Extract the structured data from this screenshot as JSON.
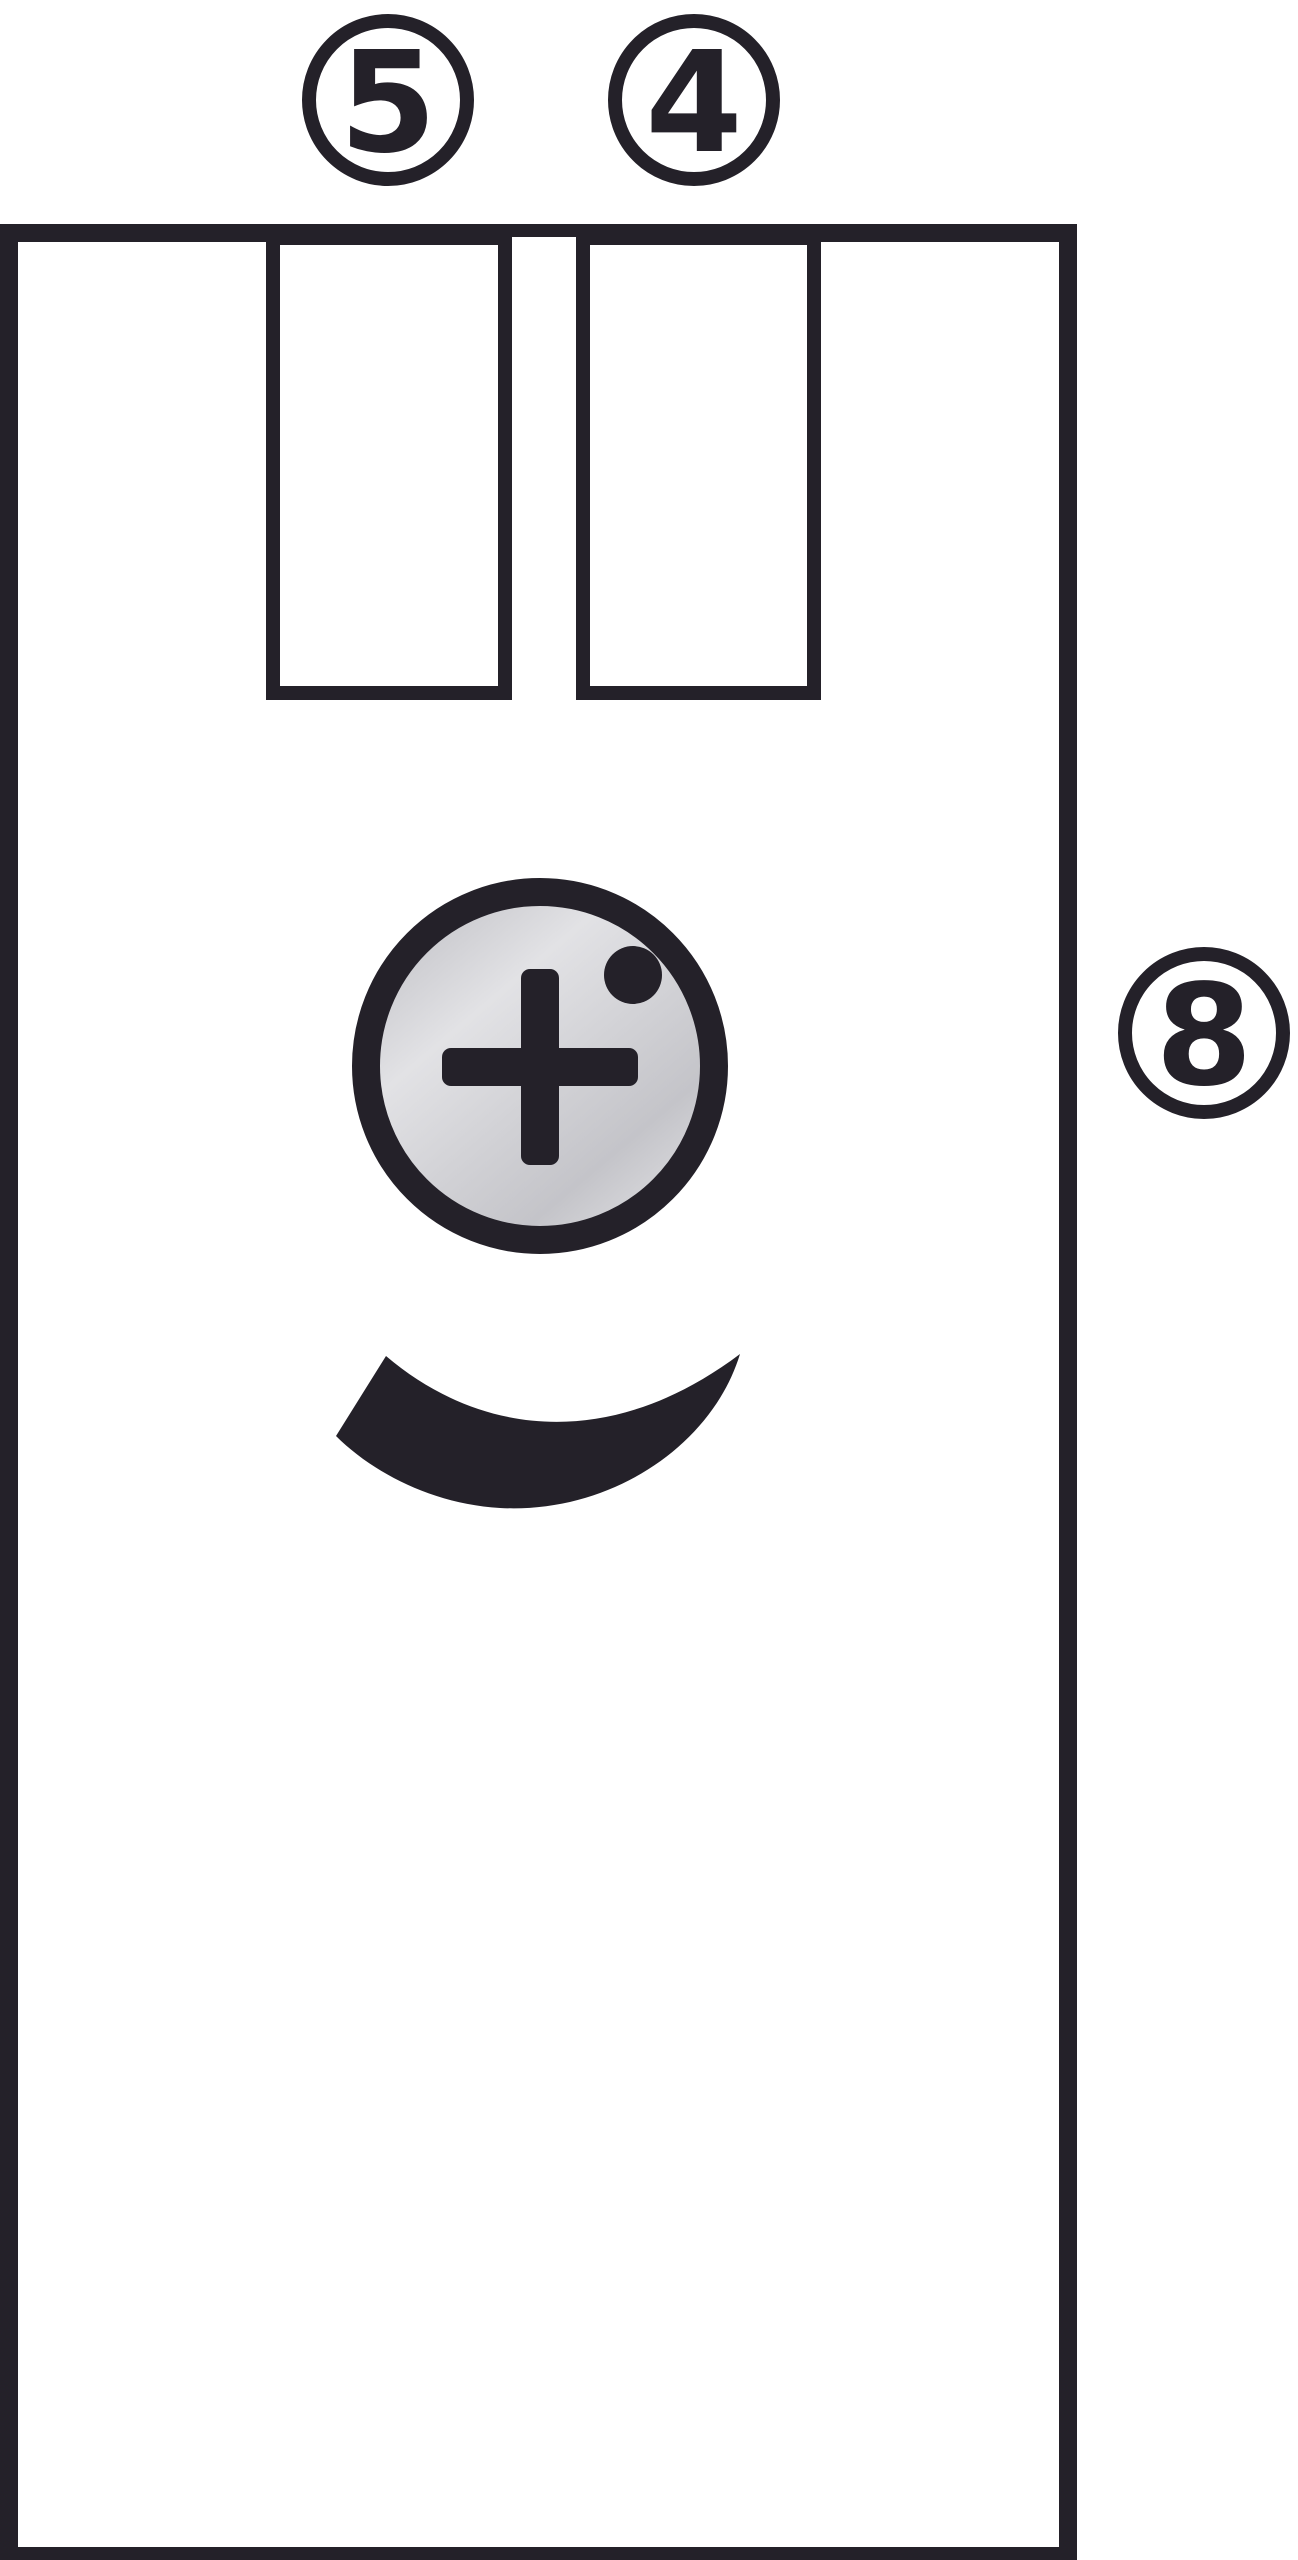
{
  "callouts": [
    {
      "label": "5"
    },
    {
      "label": "4"
    },
    {
      "label": "8"
    }
  ],
  "icons": {
    "screw_head": "phillips-cross-screw",
    "indicator": "round-dot",
    "direction": "curved-swoosh-arc"
  },
  "colors": {
    "ink": "#242129",
    "paper": "#ffffff",
    "metal-edge": "#c3c3c8",
    "metal-bright": "#e2e2e5",
    "metal-mid": "#d2d2d6",
    "metal-shade": "#c4c4c9",
    "metal-sheen": "#dedee1"
  }
}
